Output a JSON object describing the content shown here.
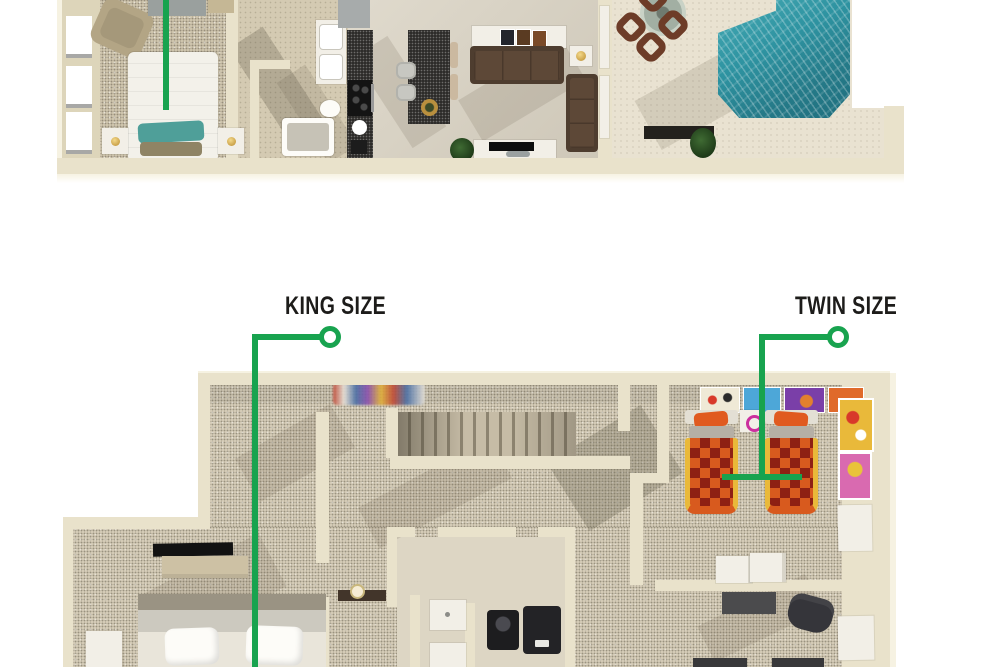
{
  "labels": {
    "king": "KING SIZE",
    "twin": "TWIN SIZE"
  },
  "colors": {
    "accent_green": "#18a34f",
    "label_text": "#1d1c1a",
    "wall_cream": "#e9e2cb",
    "wall_edge": "#f6f2e2",
    "floor_tile": "#d9d2c2",
    "floor_hall": "#d4cab2",
    "carpet_main": "#cfc5ae",
    "carpet_upper": "#d5ccb7",
    "patio_concrete": "#e9e2d1",
    "pool_teal": "#2e93a1",
    "pool_deep": "#1f6f7e",
    "sofa_frame": "#4e3d2f",
    "sofa_cushion": "#5d4837",
    "granite_dark": "#2d2c2a",
    "bed_white": "#f3f1ea",
    "pillow_teal": "#4f9f99",
    "pillow_khaki": "#8f8465",
    "twin_dark_red": "#8e2013",
    "twin_orange": "#d85a1e",
    "twin_yellow": "#e9b93a",
    "twin_pillow_orange": "#e05a20",
    "dresser_tan": "#cdc1a4",
    "dark_gray": "#3c3c3e",
    "white_furn": "#f2efe7",
    "poster_blue": "#4da7d8",
    "poster_purple": "#7a3fa8",
    "poster_pink": "#d96ab0",
    "chair_tan": "#b3a585",
    "wood_brown": "#6d3c28"
  },
  "plans": {
    "living_level": {
      "rooms": [
        "bedroom",
        "bathroom",
        "hallway",
        "kitchen",
        "living-room",
        "patio",
        "pool"
      ]
    },
    "bedroom_level": {
      "rooms": [
        "stair-landing",
        "hallway",
        "king-bedroom",
        "bathroom",
        "storage-closet",
        "twin-bedroom",
        "desk-nook"
      ]
    }
  }
}
